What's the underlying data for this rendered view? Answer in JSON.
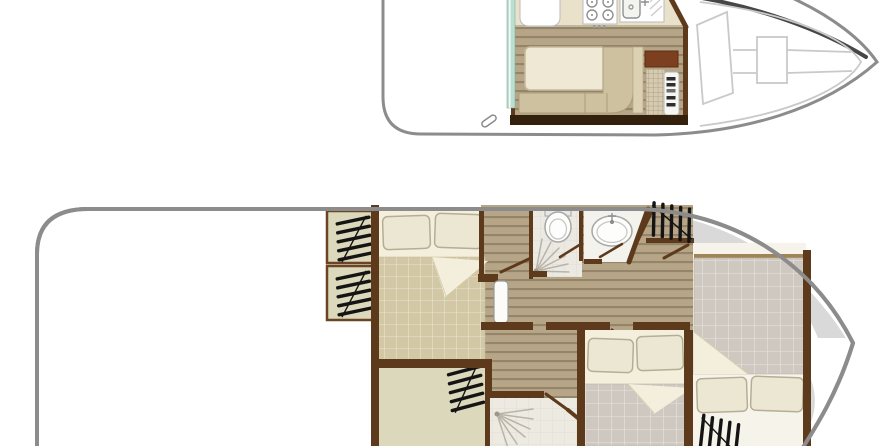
{
  "image_kind": "boat-deck-floor-plan",
  "text_content": {},
  "colors": {
    "background": "#ffffff",
    "hull_outline": "#8c8c8c",
    "upper_hull_shadow": "#474747",
    "deck_line": "#c9c9c9",
    "wall": "#5d3a1c",
    "wall_dark": "#33200d",
    "plank": "#b6a687",
    "plank_line": "#94846a",
    "counter": "#e9e1ca",
    "table": "#efe8d4",
    "bench": "#cec1a0",
    "bench_back": "#dcd1b3",
    "cabinet": "#7c4020",
    "stairs": "#d6cbb1",
    "teal_door": "#bcdfd2",
    "sheet": "#f4efdd",
    "quilt_tan": "#d2c8a6",
    "quilt_gray": "#cec8c0",
    "pillow": "#ece7d3",
    "pale_room": "#dbd8bb",
    "tile_floor": "#ebe9e1",
    "deck_gray": "#d9d9d9",
    "fixture_outline": "#a8a8a6",
    "spray": "#b9b4a9",
    "hatch": "#141414"
  },
  "decks": {
    "upper": {
      "name": "upper-deck-plan",
      "features": [
        "galley-fridge",
        "galley-stove",
        "galley-sink",
        "dinette-table",
        "l-shaped-bench",
        "helm-console",
        "companionway-stairs",
        "sliding-door-teal",
        "bow-sunpad",
        "windshield",
        "stern-cleat"
      ]
    },
    "lower": {
      "name": "lower-deck-plan",
      "features": [
        "aft-double-bed",
        "side-lockers-with-hatches",
        "wc-shower-room",
        "washbasin-room",
        "corridor-planks",
        "corridor-door-leaf",
        "mid-double-bed",
        "second-shower-room",
        "bow-double-bed",
        "gray-foredeck",
        "window-hatch-symbols"
      ]
    }
  }
}
